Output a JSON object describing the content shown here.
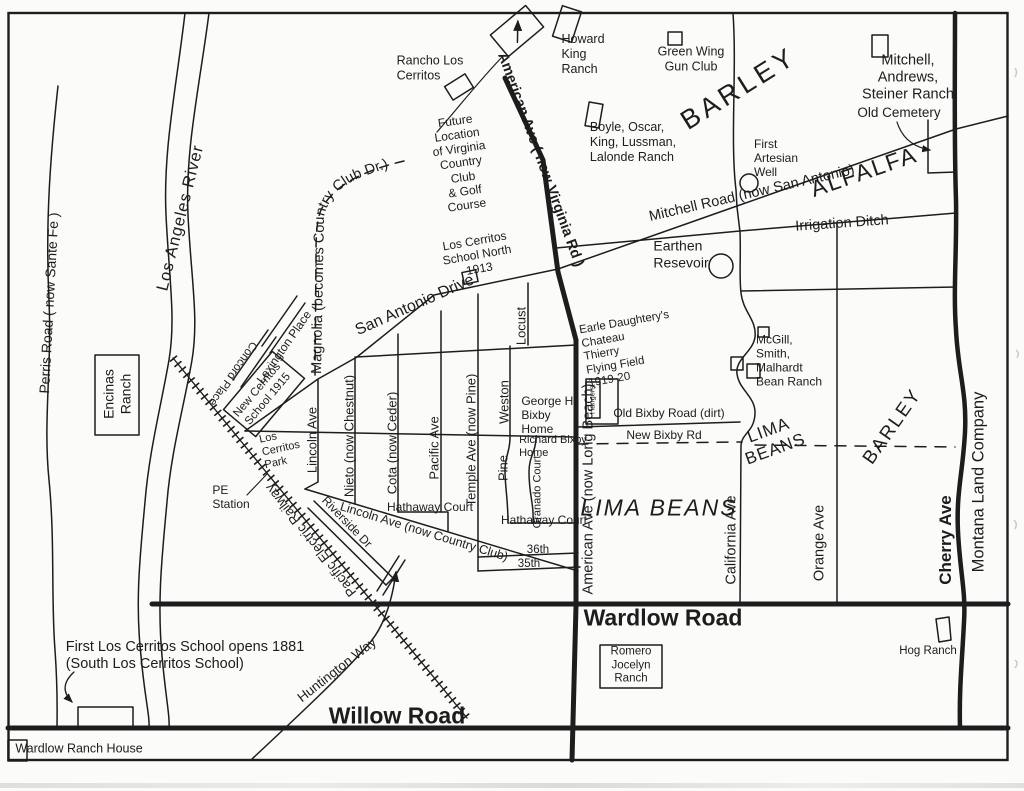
{
  "waterways": {
    "la_river": "Los Angeles River",
    "perris_road": "Perris Road ( now Sante Fe )"
  },
  "major_roads": {
    "american_virginia": "American Ave ( now Virginia Rd )",
    "american_long_beach": "American Ave (now Long Beach)",
    "mitchell_road": "Mitchell Road (now San Antonio)",
    "san_antonio_drive": "San Antonio Drive",
    "magnolia": "Magnolia (becomes Country Club Dr.)",
    "wardlow_road": "Wardlow Road",
    "willow_road": "Willow Road",
    "california_ave": "California Ave",
    "orange_ave": "Orange Ave",
    "cherry_ave": "Cherry Ave",
    "huntington_way": "Huntington Way",
    "pacific_electric": "Pacific Electric Railway"
  },
  "streets": {
    "lincoln_ave": "Lincoln Ave",
    "nieto": "Nieto (now Chestnut)",
    "cota": "Cota (now Ceder)",
    "pacific_ave": "Pacific Ave",
    "temple": "Temple Ave (now Pine)",
    "weston": "Weston",
    "pine": "Pine",
    "locust": "Locust",
    "granado": "Granado Court",
    "hathaway_west": "Hathaway Court",
    "hathaway_east": "Hathaway Court",
    "lincoln_country_club": "Lincoln Ave (now Country Club)",
    "riverside_dr": "Riverside Dr",
    "lexington_place": "Lexington Place",
    "concord_place": "Concord Place",
    "st_36th": "36th",
    "st_35th": "35th",
    "old_bixby": "Old Bixby Road (dirt)",
    "new_bixby": "New Bixby Rd",
    "irrigation_ditch": "Irrigation Ditch"
  },
  "ranches": {
    "rancho_los_cerritos": "Rancho Los\nCerritos",
    "howard_king": "Howard\nKing\nRanch",
    "green_wing": "Green Wing\nGun Club",
    "mitchell_andrews": "Mitchell, Andrews,\nSteiner Ranch",
    "boyle": "Boyle, Oscar,\nKing, Lussman,\nLalonde Ranch",
    "mcgill": "McGill,\nSmith,\nMalhardt\nBean Ranch",
    "encinas": "Encinas\nRanch",
    "romero": "Romero\nJocelyn\nRanch",
    "hog": "Hog Ranch",
    "wardlow_ranch_house": "Wardlow Ranch House",
    "montana": "Montana Land Company"
  },
  "schools": {
    "school_north": "Los Cerritos\nSchool North\n1913",
    "new_cerritos": "New Cerritos\nSchool 1915",
    "first_school": "First Los Cerritos School opens 1881\n(South Los Cerritos School)"
  },
  "homes": {
    "george_bixby": "George H.\nBixby\nHome",
    "richard_bixby": "Richard Bixby\nHome"
  },
  "crops": {
    "barley_north": "BARLEY",
    "barley_east": "BARLEY",
    "alfalfa": "ALFALFA",
    "lima_beans_small": "LIMA\nBEANS",
    "lima_beans_large": "LIMA BEANS"
  },
  "features": {
    "future_club": "Future\nLocation\nof Virginia\nCountry\nClub\n& Golf\nCourse",
    "old_cemetery": "Old Cemetery",
    "first_artesian": "First\nArtesian\nWell",
    "earthen_resevoir": "Earthen\nResevoir",
    "flying_field": "Earle Daughtery's\nChateau\nThierry\nFlying Field\n1919-20",
    "hangers": "Hangers",
    "los_cerritos_park": "Los\nCerritos\nPark",
    "pe_station": "PE\nStation"
  }
}
